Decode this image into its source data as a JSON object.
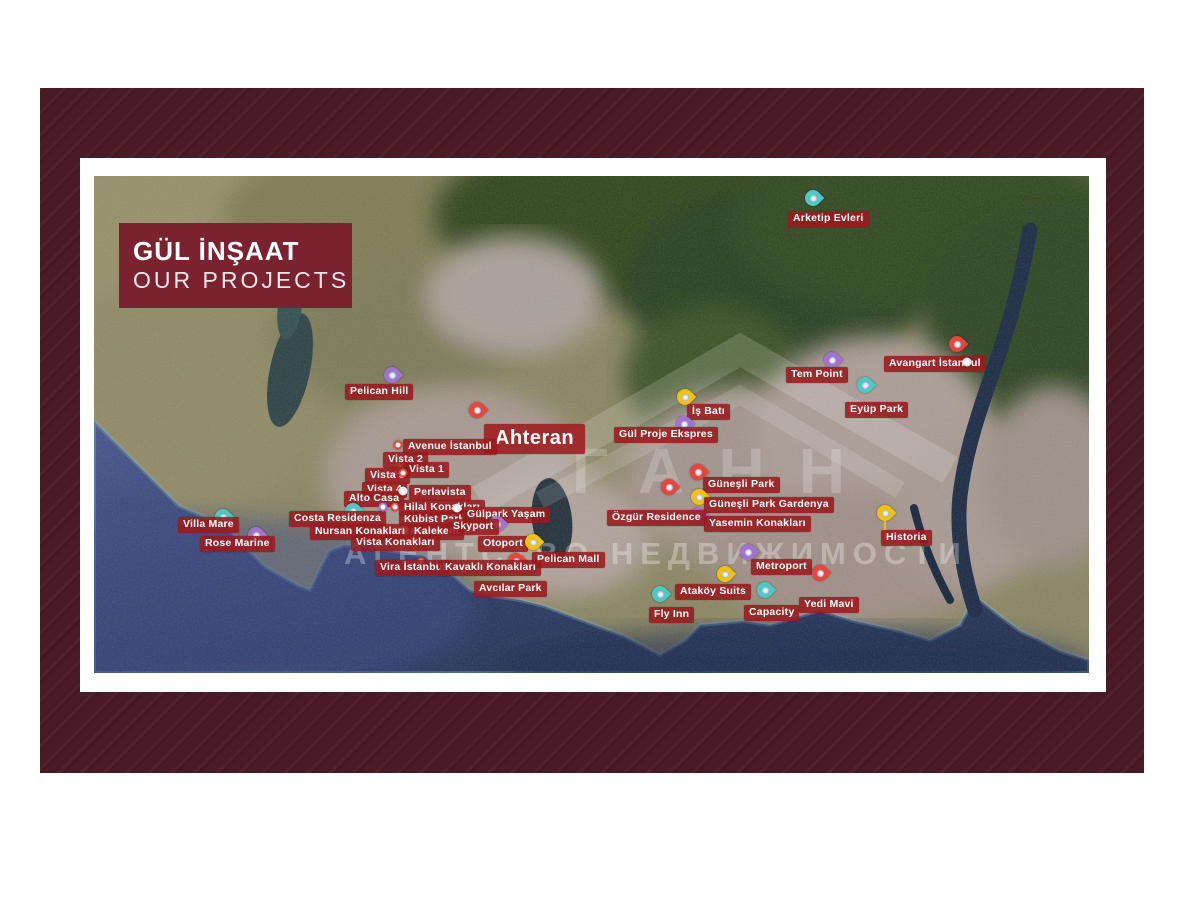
{
  "theme": {
    "frame": "#4a1a26",
    "title_bg": "#7b2231",
    "label_bg": "#9a1a1e",
    "sea": "#2c3a66",
    "forest": "#2b4020",
    "urban": "#a79a92"
  },
  "title_block": {
    "line1": "GÜL İNŞAAT",
    "line2": "OUR PROJECTS"
  },
  "watermark": {
    "name": "ГАНН",
    "tagline": "АГЕНТСТВО НЕДВИЖИМОСТИ"
  },
  "map": {
    "pin_colors": {
      "red": "#e8453c",
      "yellow": "#f2c211",
      "purple": "#a374ce",
      "teal": "#4fc8c4",
      "white": "#e8e8e8"
    },
    "projects": [
      {
        "label": "Pelican Hill",
        "lx": 345,
        "ly": 384,
        "pin": {
          "style": "pin",
          "color": "purple",
          "x": 392,
          "y": 375
        }
      },
      {
        "label": "Ahteran",
        "variant": "large",
        "lx": 484,
        "ly": 424,
        "pin": {
          "style": "pin",
          "color": "red",
          "x": 477,
          "y": 410
        }
      },
      {
        "label": "Avenue İstanbul",
        "lx": 403,
        "ly": 439,
        "pin": {
          "style": "dot",
          "color": "red",
          "x": 398,
          "y": 445
        }
      },
      {
        "label": "Vista 2",
        "lx": 383,
        "ly": 452,
        "pin": {
          "style": "pin-s",
          "color": "yellow",
          "x": 400,
          "y": 466
        }
      },
      {
        "label": "Vista 1",
        "lx": 404,
        "ly": 462,
        "pin": {
          "style": "dot",
          "color": "red",
          "x": 396,
          "y": 473
        }
      },
      {
        "label": "Vista 3",
        "lx": 365,
        "ly": 468,
        "pin": {
          "style": "dot",
          "color": "red",
          "x": 390,
          "y": 474
        }
      },
      {
        "label": "Vista 4",
        "lx": 362,
        "ly": 482,
        "pin": {
          "style": "pin-s",
          "color": "yellow",
          "x": 393,
          "y": 490
        }
      },
      {
        "label": "Alto Casa",
        "lx": 344,
        "ly": 491,
        "pin": {
          "style": "none"
        }
      },
      {
        "label": "Perlavista",
        "lx": 409,
        "ly": 485,
        "pin": {
          "style": "dot",
          "color": "white",
          "x": 403,
          "y": 491
        }
      },
      {
        "label": "Hilal Konakları",
        "lx": 399,
        "ly": 500,
        "pin": {
          "style": "dot",
          "color": "red",
          "x": 395,
          "y": 507
        }
      },
      {
        "label": "Kübist Park",
        "lx": 399,
        "ly": 512,
        "pin": {
          "style": "dot",
          "color": "white",
          "x": 453,
          "y": 518
        }
      },
      {
        "label": "Kalekent",
        "lx": 409,
        "ly": 524,
        "pin": {
          "style": "dot",
          "color": "white",
          "x": 404,
          "y": 530
        }
      },
      {
        "label": "Costa Residenza",
        "lx": 289,
        "ly": 511,
        "pin": {
          "style": "pin",
          "color": "teal",
          "x": 353,
          "y": 511
        }
      },
      {
        "label": "Nursan Konakları",
        "lx": 310,
        "ly": 524,
        "pin": {
          "style": "none"
        }
      },
      {
        "label": "Vista Konakları",
        "lx": 351,
        "ly": 535,
        "pin": {
          "style": "dot",
          "color": "red",
          "x": 414,
          "y": 541
        }
      },
      {
        "label": "Vira İstanbul",
        "lx": 375,
        "ly": 560,
        "pin": {
          "style": "dot",
          "color": "red",
          "x": 421,
          "y": 562
        }
      },
      {
        "label": "Villa Mare",
        "lx": 178,
        "ly": 517,
        "pin": {
          "style": "pin",
          "color": "teal",
          "x": 223,
          "y": 517
        }
      },
      {
        "label": "Rose Marine",
        "lx": 200,
        "ly": 536,
        "pin": {
          "style": "pin",
          "color": "purple",
          "x": 256,
          "y": 535
        }
      },
      {
        "label": "Gülpark Yaşam",
        "lx": 462,
        "ly": 507,
        "pin": {
          "style": "dot",
          "color": "white",
          "x": 457,
          "y": 508
        }
      },
      {
        "label": "Skyport",
        "lx": 448,
        "ly": 519,
        "pin": {
          "style": "pin",
          "color": "purple",
          "x": 497,
          "y": 524
        }
      },
      {
        "label": "Otoport",
        "lx": 478,
        "ly": 536,
        "pin": {
          "style": "none"
        }
      },
      {
        "label": "Pelican Mall",
        "lx": 532,
        "ly": 552,
        "pin": {
          "style": "pin",
          "color": "yellow",
          "x": 533,
          "y": 542
        }
      },
      {
        "label": "Kavaklı Konakları",
        "lx": 440,
        "ly": 560,
        "pin": {
          "style": "pin",
          "color": "red",
          "x": 516,
          "y": 561
        }
      },
      {
        "label": "Avcılar Park",
        "lx": 474,
        "ly": 581,
        "pin": {
          "style": "none"
        }
      },
      {
        "label": "İş Batı",
        "lx": 687,
        "ly": 404,
        "pin": {
          "style": "pin",
          "color": "yellow",
          "x": 685,
          "y": 397
        }
      },
      {
        "label": "Gül Proje Ekspres",
        "lx": 614,
        "ly": 427,
        "pin": {
          "style": "pin",
          "color": "purple",
          "x": 684,
          "y": 424
        }
      },
      {
        "label": "Güneşli Park",
        "lx": 703,
        "ly": 477,
        "pin": {
          "style": "pin",
          "color": "red",
          "x": 698,
          "y": 472
        }
      },
      {
        "label": "Güneşli Park Gardenya",
        "lx": 704,
        "ly": 497,
        "pin": {
          "style": "pin",
          "color": "yellow",
          "x": 699,
          "y": 497
        }
      },
      {
        "label": "Yasemin Konakları",
        "lx": 704,
        "ly": 516,
        "pin": {
          "style": "pin",
          "color": "purple",
          "x": 698,
          "y": 516
        }
      },
      {
        "label": "Özgür Residence",
        "lx": 607,
        "ly": 510,
        "pin": {
          "style": "pin",
          "color": "red",
          "x": 669,
          "y": 487
        }
      },
      {
        "label": "Metroport",
        "lx": 751,
        "ly": 559,
        "pin": {
          "style": "pin",
          "color": "purple",
          "x": 748,
          "y": 552
        }
      },
      {
        "label": "Ataköy Suits",
        "lx": 675,
        "ly": 584,
        "pin": {
          "style": "pin",
          "color": "yellow",
          "x": 725,
          "y": 574
        }
      },
      {
        "label": "Fly Inn",
        "lx": 649,
        "ly": 607,
        "pin": {
          "style": "pin",
          "color": "teal",
          "x": 660,
          "y": 594
        }
      },
      {
        "label": "Capacity",
        "lx": 744,
        "ly": 605,
        "pin": {
          "style": "pin",
          "color": "teal",
          "x": 765,
          "y": 590
        }
      },
      {
        "label": "Yedi Mavi",
        "lx": 799,
        "ly": 597,
        "pin": {
          "style": "pin",
          "color": "red",
          "x": 820,
          "y": 573
        }
      },
      {
        "label": "Historia",
        "lx": 881,
        "ly": 530,
        "pin": {
          "style": "pin",
          "color": "yellow",
          "x": 885,
          "y": 513
        },
        "stem": true
      },
      {
        "label": "Tem Point",
        "lx": 786,
        "ly": 367,
        "pin": {
          "style": "pin",
          "color": "purple",
          "x": 832,
          "y": 360
        }
      },
      {
        "label": "Eyüp Park",
        "lx": 845,
        "ly": 402,
        "pin": {
          "style": "pin",
          "color": "teal",
          "x": 865,
          "y": 385
        }
      },
      {
        "label": "Avangart İstanbul",
        "lx": 884,
        "ly": 356,
        "pin": {
          "style": "pin",
          "color": "red",
          "x": 957,
          "y": 344
        }
      },
      {
        "label": "Arketip Evleri",
        "lx": 788,
        "ly": 211,
        "pin": {
          "style": "pin",
          "color": "teal",
          "x": 813,
          "y": 198
        }
      }
    ],
    "extra_pins": [
      {
        "style": "dot",
        "color": "red",
        "x": 403,
        "y": 473
      },
      {
        "style": "dot",
        "color": "white",
        "x": 967,
        "y": 362
      },
      {
        "style": "dot",
        "color": "purple",
        "x": 383,
        "y": 507
      }
    ]
  }
}
